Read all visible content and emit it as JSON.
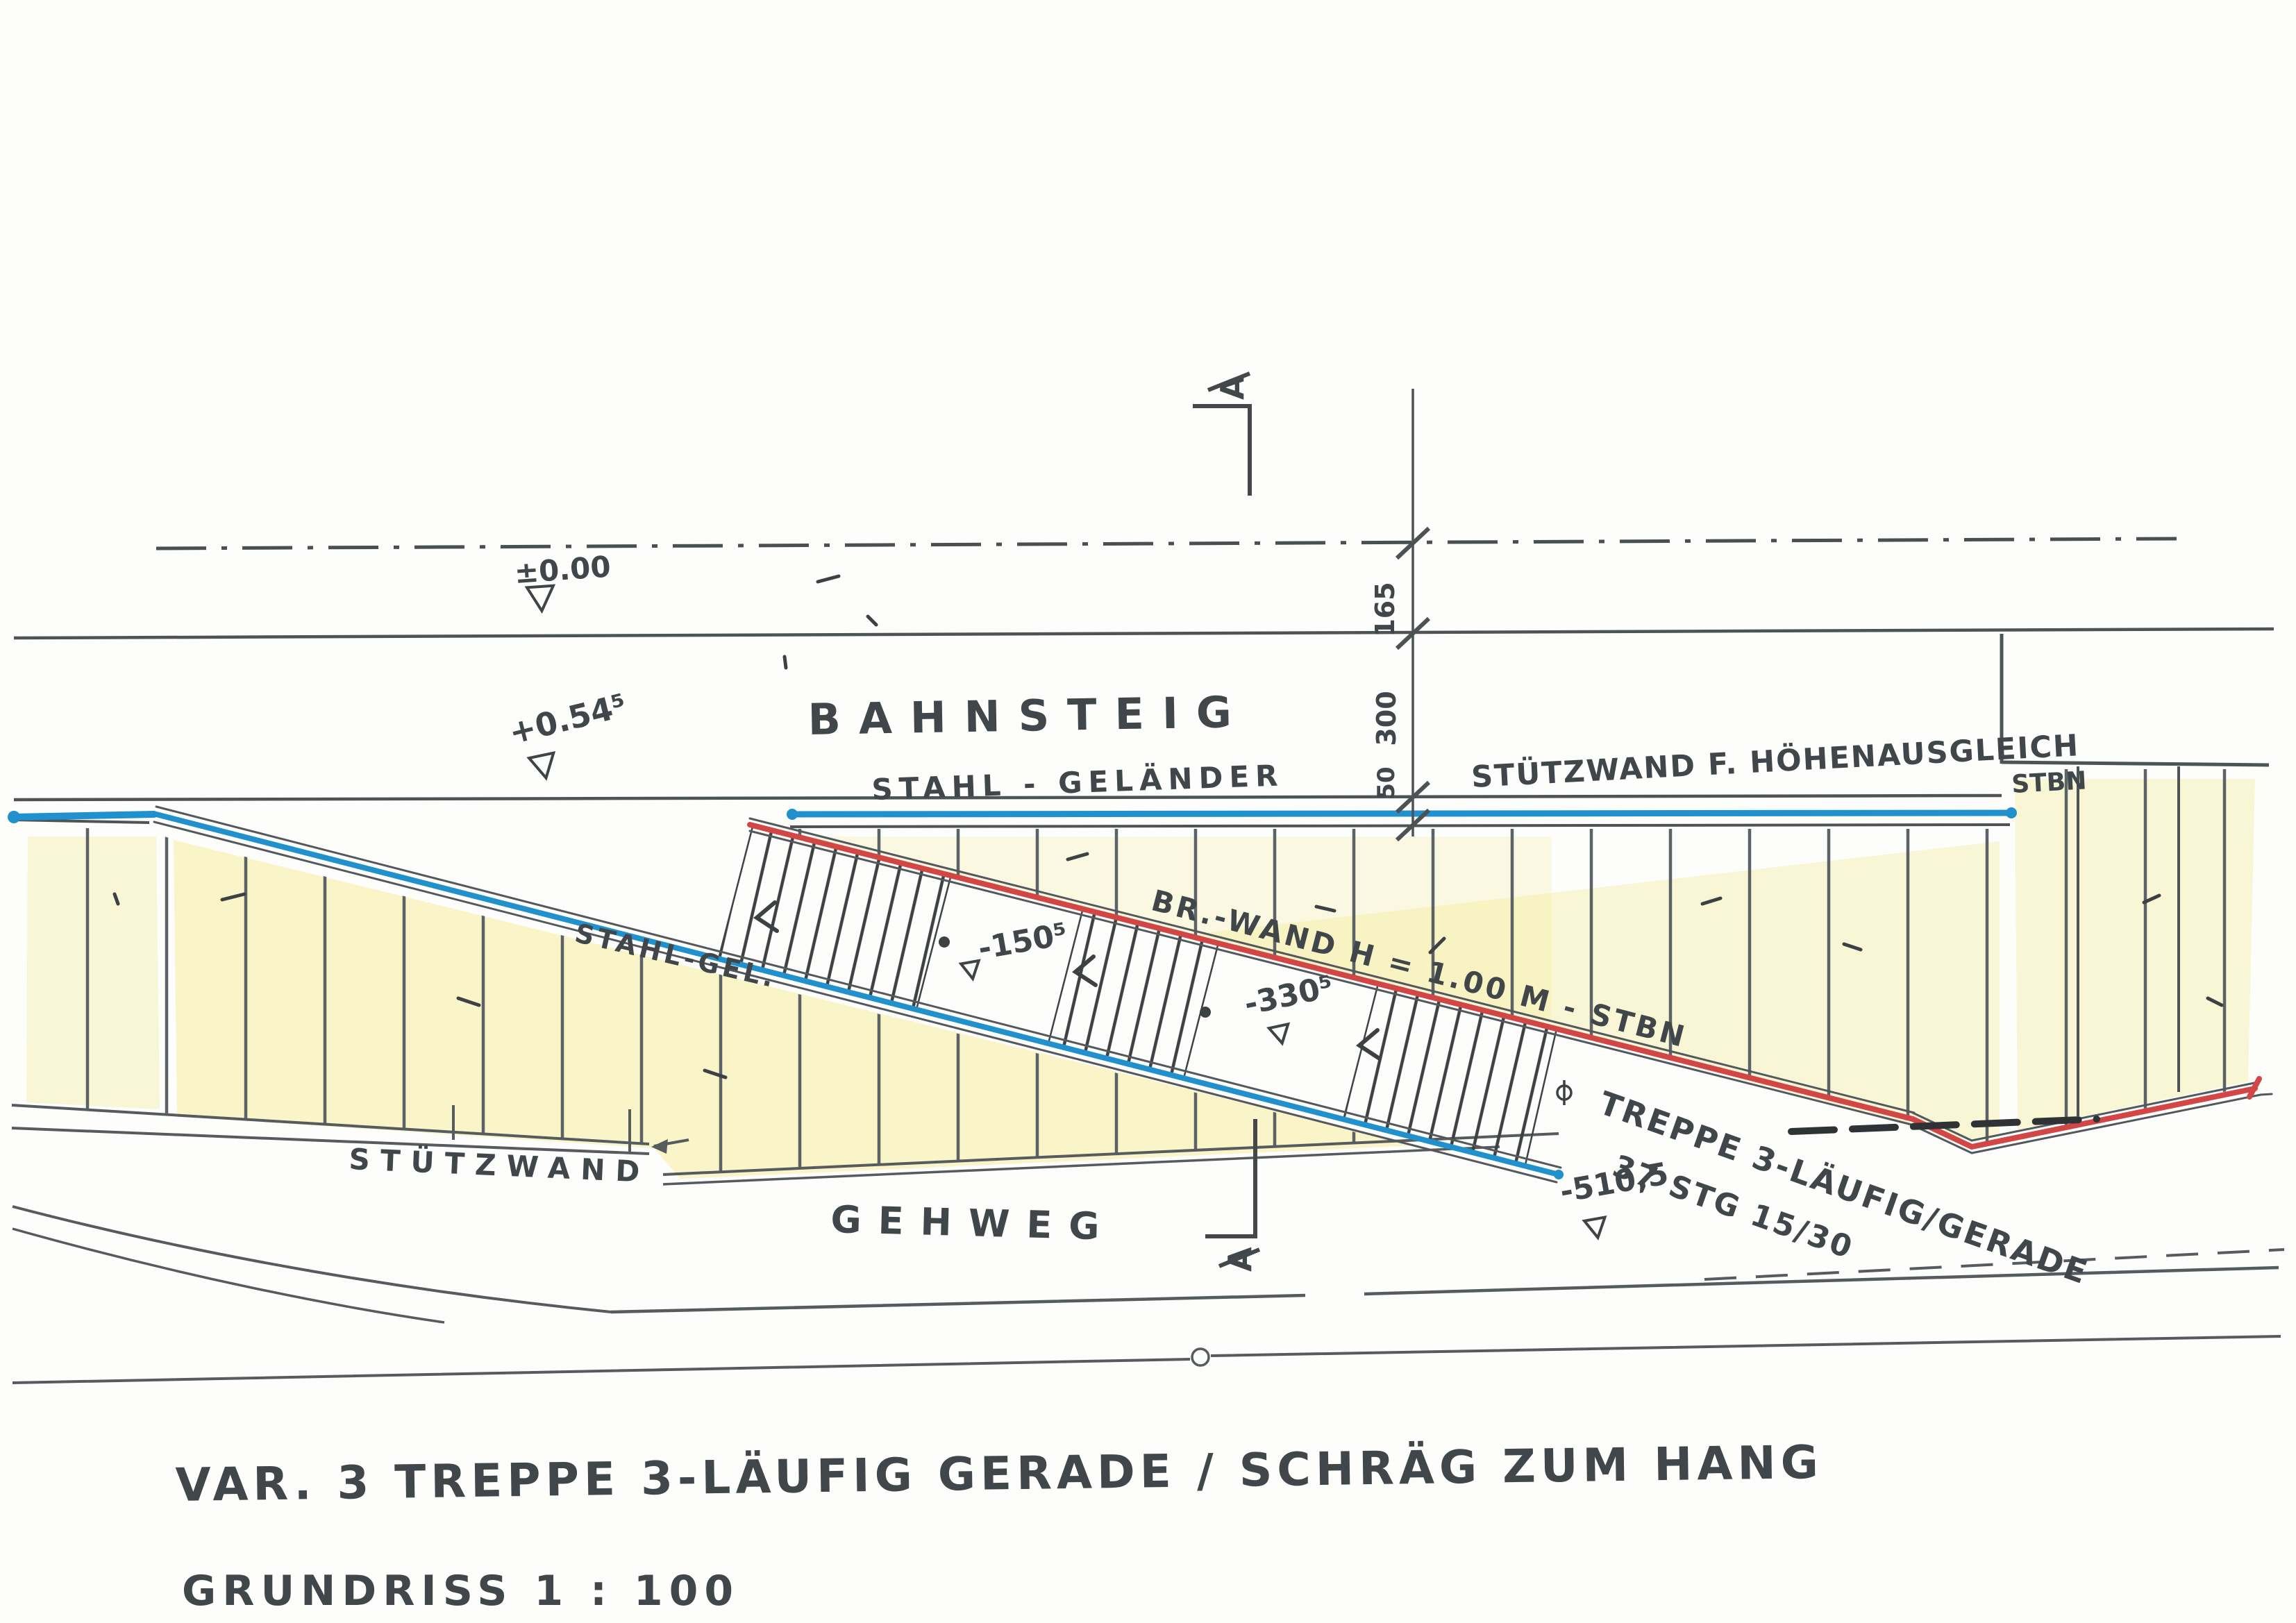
{
  "title": {
    "line1": "VAR. 3   TREPPE 3-LÄUFIG GERADE / SCHRÄG ZUM HANG",
    "line2": "GRUNDRISS   1 : 100"
  },
  "areas": {
    "platform": "BAHNSTEIG",
    "walkway": "GEHWEG"
  },
  "annotations": {
    "railing_top": "STAHL - GELÄNDER",
    "railing_slope": "STAHL-GEL.",
    "retaining_wall_top": "STÜTZWAND F. HÖHENAUSGLEICH",
    "retaining_wall_material": "STBN",
    "retaining_wall_left": "STÜTZWAND",
    "parapet_wall": "BR.-WAND H = 1.00 M - STBN",
    "stair_note_line1": "TREPPE 3-LÄUFIG/GERADE",
    "stair_note_line2": "37 STG 15/30"
  },
  "levels": {
    "track_axis": "±0.00",
    "platform": "+0.54⁵",
    "landing1": "-150⁵",
    "landing2": "-330⁵",
    "stair_foot": "-510,5"
  },
  "dimensions": {
    "d_track_to_platform": "165",
    "d_platform_width": "300",
    "d_edge": "50"
  },
  "section_marker": {
    "label": "A"
  },
  "colors": {
    "pencil": "#4a4f53",
    "railing_blue": "#2191cd",
    "wall_red": "#d24646",
    "terrain_yellow": "#f3e97f"
  }
}
